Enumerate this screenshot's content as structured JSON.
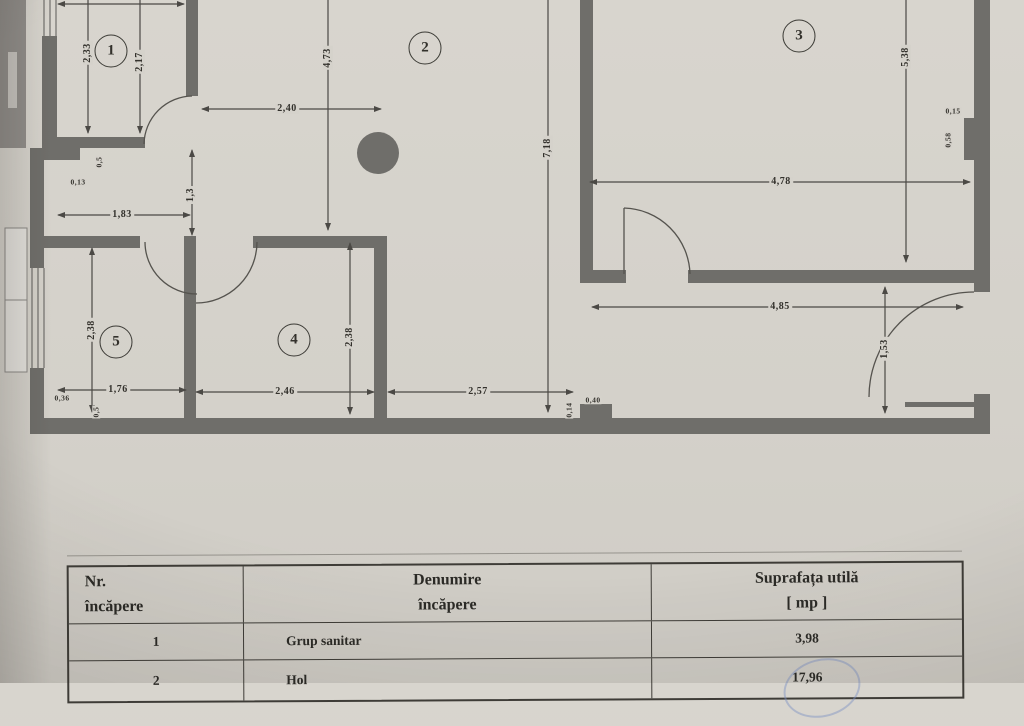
{
  "colors": {
    "paper": "#d5d2cb",
    "wall": "#6f6e6a",
    "line": "#4b4945",
    "text": "#33312c",
    "stamp_blue": "#7d91c3"
  },
  "plan": {
    "rooms": [
      {
        "number": "1"
      },
      {
        "number": "2"
      },
      {
        "number": "3"
      },
      {
        "number": "4"
      },
      {
        "number": "5"
      }
    ],
    "dims": {
      "room1_left": "2,33",
      "room1_right": "2,17",
      "hall_top": "2,40",
      "room2_h": "4,73",
      "total_h": "7,18",
      "r3_h": "5,38",
      "r3_w": "4,78",
      "niche_w": "0,15",
      "niche_h": "0,58",
      "left_w": "1,83",
      "mid_gap": "1,3",
      "notch_w": "0,5",
      "notch_h": "0,13",
      "r5_h": "2,38",
      "r5_w": "1,76",
      "r5_sill": "0,36",
      "r5_sill2": "0,5",
      "r4_h": "2,38",
      "r4_w": "2,46",
      "hol_w": "2,57",
      "step_h": "0,14",
      "step_w": "0,40",
      "low_w": "4,85",
      "low_h": "1,53"
    }
  },
  "table": {
    "headers": [
      {
        "line1": "Nr.",
        "line2": "încăpere"
      },
      {
        "line1": "Denumire",
        "line2": "încăpere"
      },
      {
        "line1": "Suprafața utilă",
        "line2": "[ mp ]"
      }
    ],
    "rows": [
      {
        "nr": "1",
        "name": "Grup sanitar",
        "area": "3,98"
      },
      {
        "nr": "2",
        "name": "Hol",
        "area": "17,96"
      }
    ]
  }
}
